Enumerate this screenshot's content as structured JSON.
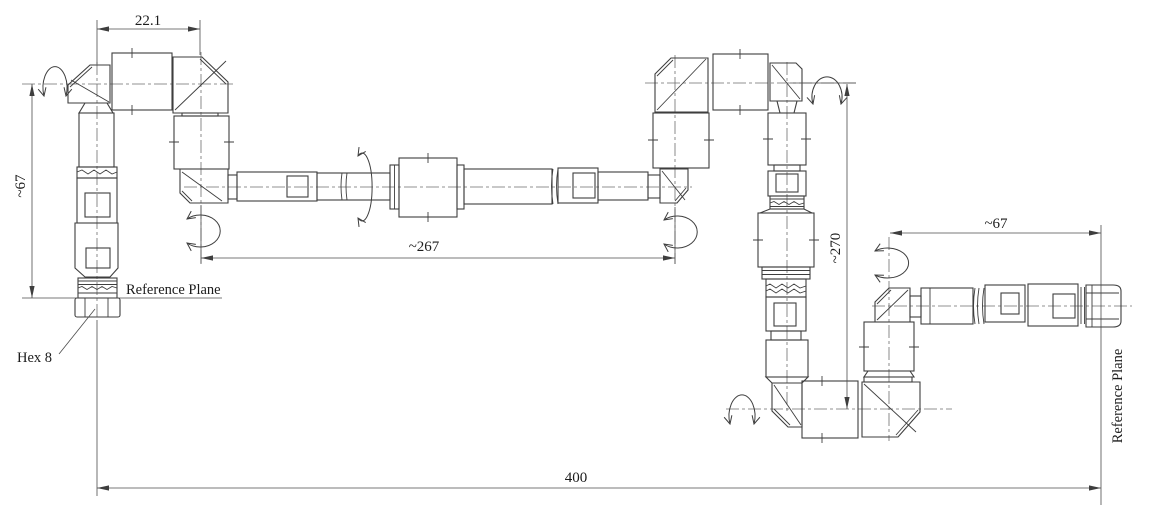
{
  "dimensions": {
    "top_left": "22.1",
    "left_height": "~67",
    "middle_length": "~267",
    "right_height": "~270",
    "right_length": "~67",
    "overall_length": "400"
  },
  "labels": {
    "reference_plane_left": "Reference Plane",
    "reference_plane_right": "Reference Plane",
    "hex": "Hex 8"
  },
  "colors": {
    "background": "#ffffff",
    "object_line": "#3e3e3e",
    "thin_line": "#4c4c4c",
    "center_line": "#6e6e6e",
    "text": "#1c1c1c"
  }
}
